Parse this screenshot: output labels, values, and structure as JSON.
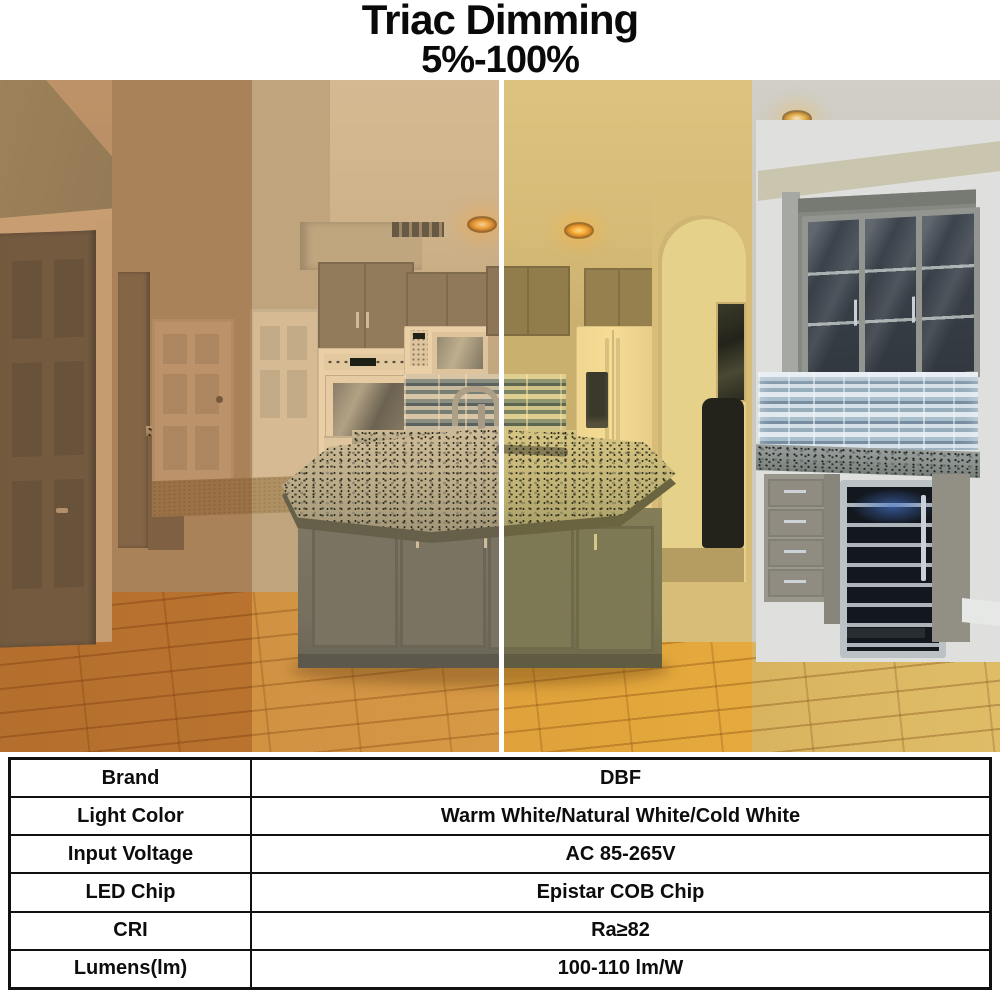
{
  "header": {
    "title": "Triac Dimming",
    "subtitle": "5%-100%"
  },
  "photo": {
    "bands": [
      {
        "name": "warm-white-dim",
        "tint": "rgba(190,105,25,0.55)"
      },
      {
        "name": "warm-white",
        "tint": "rgba(235,175,90,0.45)"
      },
      {
        "name": "natural-white",
        "tint": "rgba(255,205,60,0.50)"
      },
      {
        "name": "cold-white",
        "tint": "rgba(215,225,235,0.35)"
      }
    ],
    "divider_color": "#ffffff",
    "glow_color": "#f5be5e"
  },
  "table": {
    "rows": [
      {
        "label": "Brand",
        "value": "DBF"
      },
      {
        "label": "Light Color",
        "value": "Warm White/Natural White/Cold White"
      },
      {
        "label": "Input Voltage",
        "value": "AC 85-265V"
      },
      {
        "label": "LED Chip",
        "value": "Epistar COB Chip"
      },
      {
        "label": "CRI",
        "value": "Ra≥82"
      },
      {
        "label": "Lumens(lm)",
        "value": "100-110 lm/W"
      }
    ]
  }
}
